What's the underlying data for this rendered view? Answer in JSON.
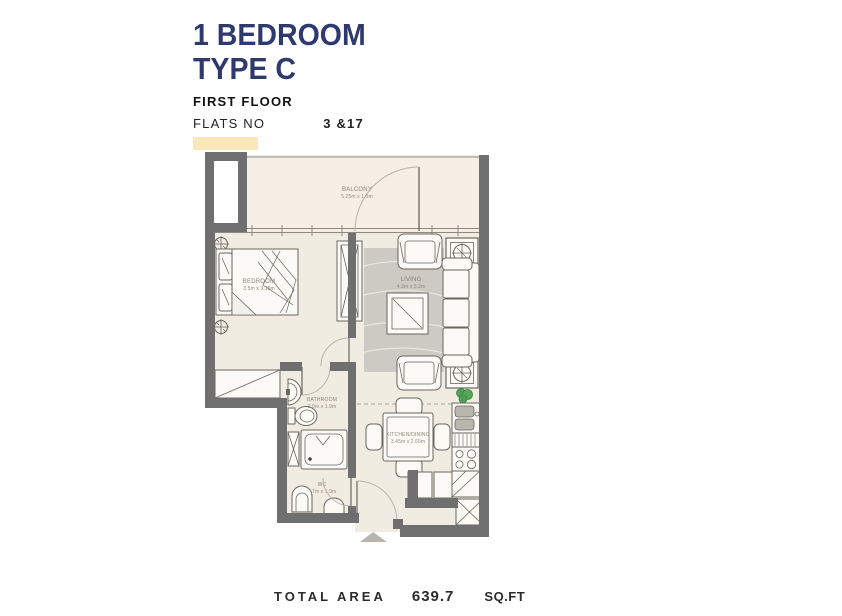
{
  "header": {
    "title_line1": "1 BEDROOM",
    "title_line2": "TYPE C",
    "floor_label": "FIRST FLOOR",
    "flats_label": "FLATS NO",
    "flats_value": "3 &17"
  },
  "plan": {
    "rooms": [
      {
        "name": "BALCONY",
        "dims": "5.25m x 1.5m"
      },
      {
        "name": "BEDROOM",
        "dims": "3.5m x 3.15m"
      },
      {
        "name": "LIVING",
        "dims": "4.3m x 3.2m"
      },
      {
        "name": "BATHROOM",
        "dims": "2.0m x 1.9m"
      },
      {
        "name": "WC",
        "dims": "1.7m x 1.9m"
      },
      {
        "name": "KITCHEN/DINING",
        "dims": "3.45m x 2.65m"
      }
    ]
  },
  "footer": {
    "total_area_label": "TOTAL AREA",
    "total_area_value": "639.7",
    "total_area_unit": "SQ.FT"
  },
  "colors": {
    "title_navy": "#2e3a6e",
    "highlight_yellow": "#fbe8ba",
    "wall_gray": "#6f6f6f",
    "floor_cream": "#f1ece2",
    "balcony_cream": "#f5efe6",
    "rug_gray": "#cdc9c3",
    "plant_green": "#4f9f55"
  }
}
